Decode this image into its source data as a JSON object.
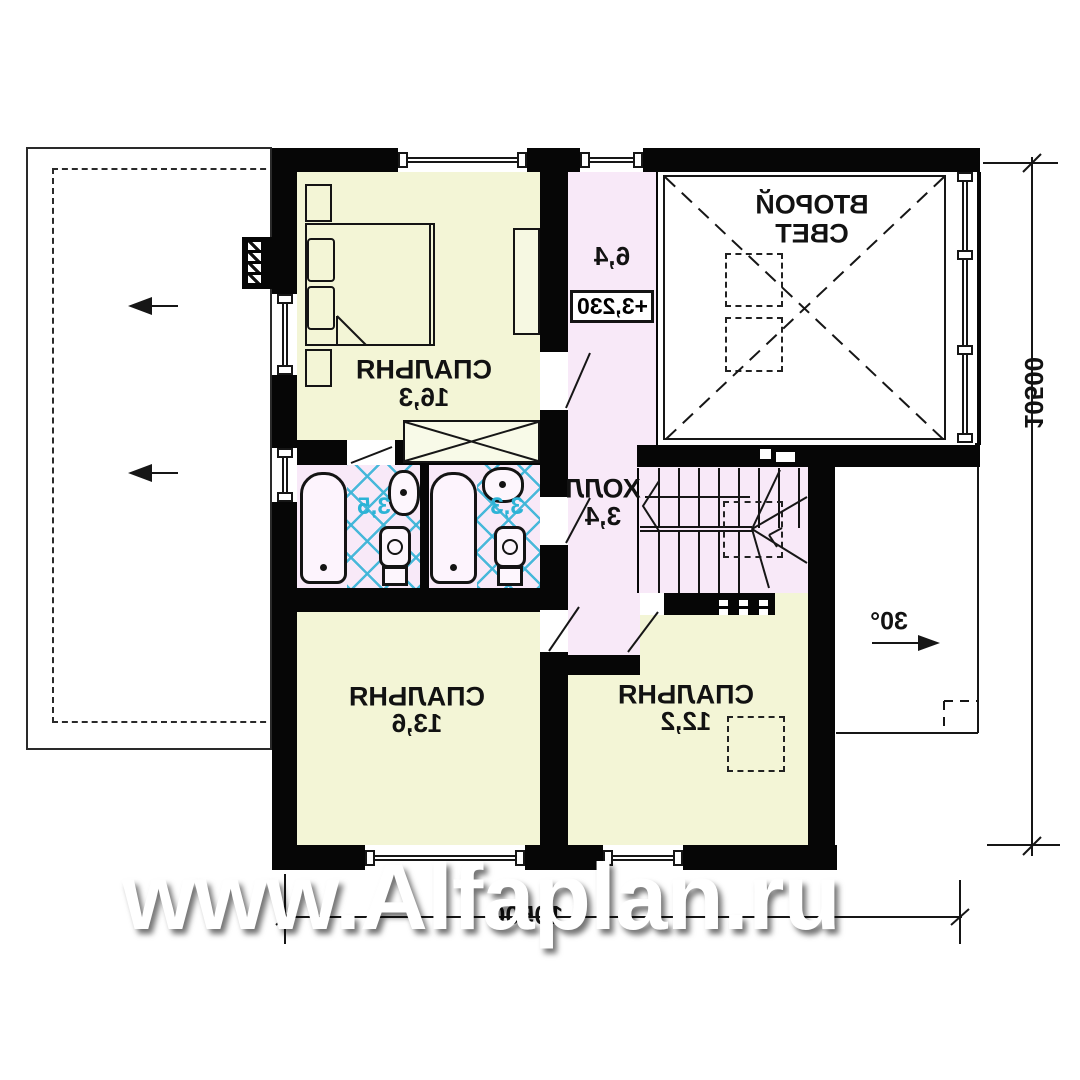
{
  "plan": {
    "watermark": "www.Alfaplan.ru",
    "rooms": {
      "bedroom_top": {
        "name": "СПАЛЬНЯ",
        "area": "16,3"
      },
      "bedroom_bottom_left": {
        "name": "СПАЛЬНЯ",
        "area": "13,6"
      },
      "bedroom_bottom_mid": {
        "name": "СПАЛЬНЯ",
        "area": "12,2"
      },
      "hall": {
        "name": "ХОЛЛ",
        "area": "3,4"
      },
      "corridor": {
        "area": "6,4"
      },
      "second_light": {
        "name_line1": "ВТОРОЙ",
        "name_line2": "СВЕТ"
      },
      "bathroom_left": {
        "area": "3,5"
      },
      "bathroom_right": {
        "area": "3,3"
      }
    },
    "annotations": {
      "level_mark": "+3,230",
      "roof_slope": "30°"
    },
    "dimensions": {
      "bottom": "10500",
      "right": "10500"
    },
    "colors": {
      "wall": "#060606",
      "room_yellow": "#f3f5d6",
      "zone_pink": "#f8e9f8",
      "tile_cyan": "#3eb5d8",
      "bath_label_cyan": "#2cb3d6"
    }
  }
}
